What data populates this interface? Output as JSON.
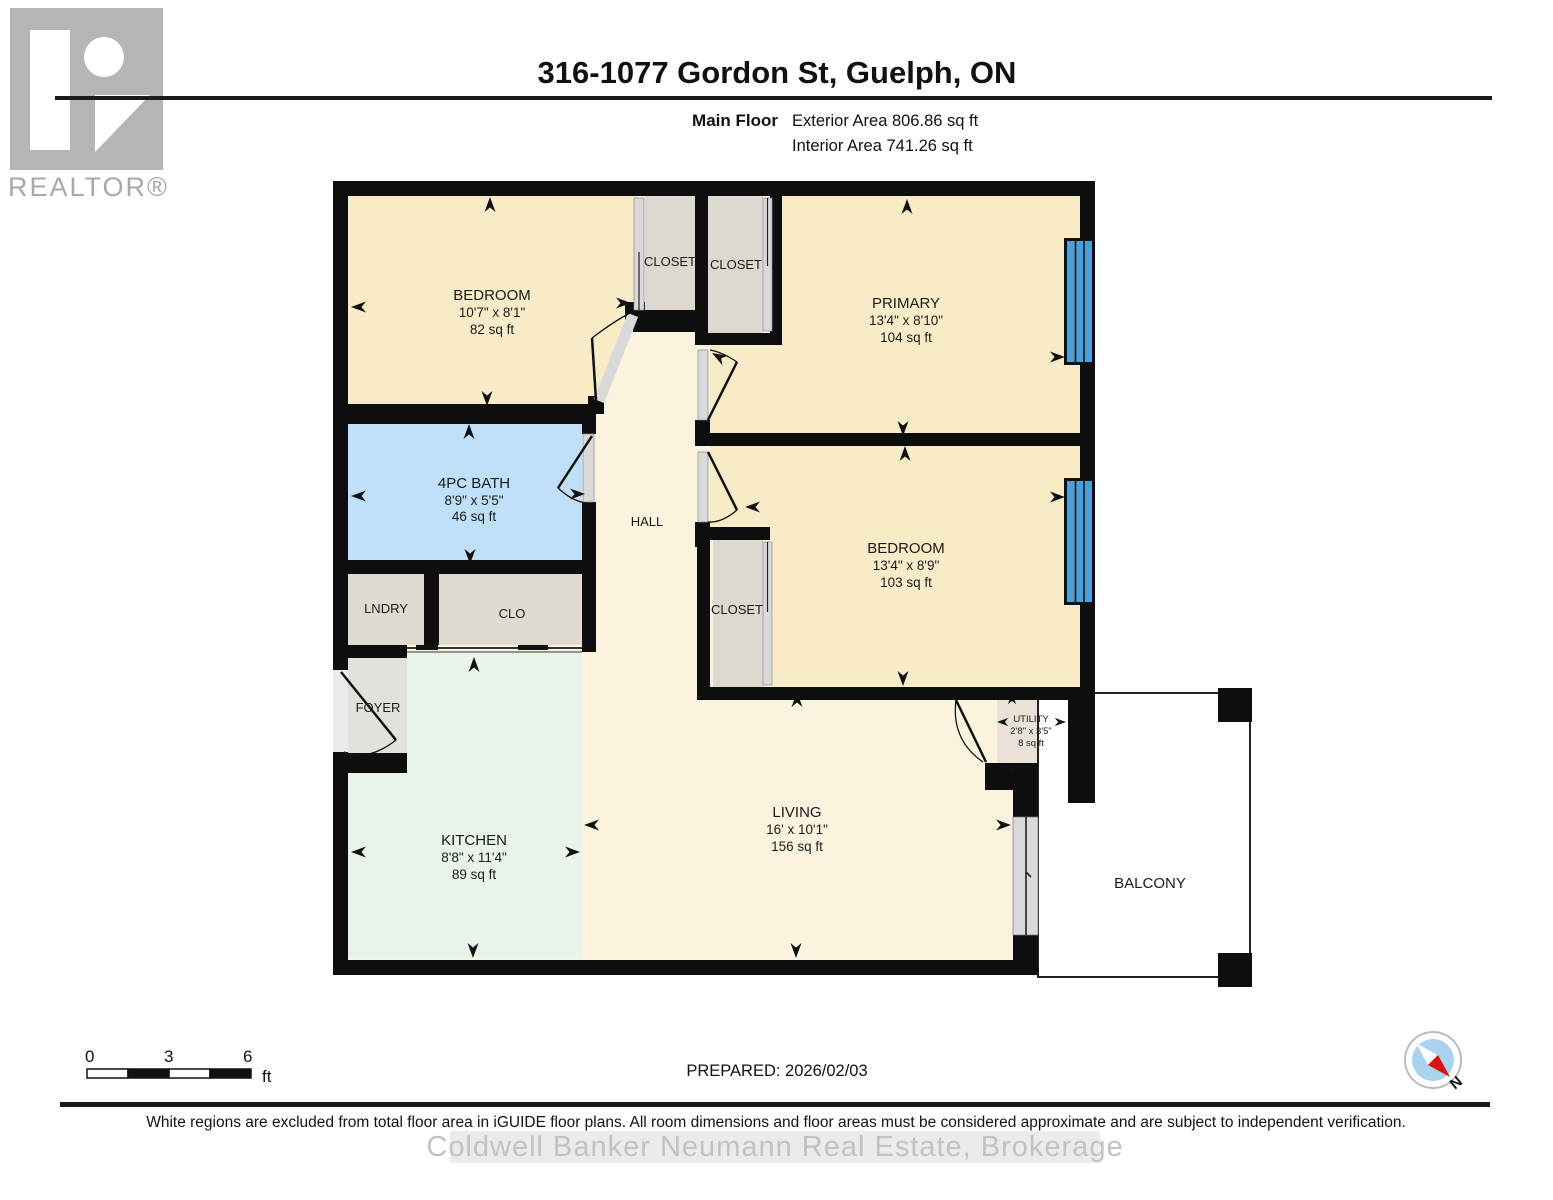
{
  "header": {
    "title": "316-1077 Gordon St, Guelph, ON",
    "floor_label": "Main Floor",
    "exterior_area": "Exterior Area 806.86 sq ft",
    "interior_area": "Interior Area 741.26 sq ft"
  },
  "branding": {
    "logo_letter": "R",
    "logo_wordmark": "REALTOR®"
  },
  "plan": {
    "bedroom1": {
      "name": "BEDROOM",
      "dims": "10'7\" x 8'1\"",
      "area": "82 sq ft"
    },
    "primary": {
      "name": "PRIMARY",
      "dims": "13'4\" x 8'10\"",
      "area": "104 sq ft"
    },
    "bedroom2": {
      "name": "BEDROOM",
      "dims": "13'4\" x 8'9\"",
      "area": "103 sq ft"
    },
    "bath": {
      "name": "4PC BATH",
      "dims": "8'9\" x 5'5\"",
      "area": "46 sq ft"
    },
    "kitchen": {
      "name": "KITCHEN",
      "dims": "8'8\" x 11'4\"",
      "area": "89 sq ft"
    },
    "living": {
      "name": "LIVING",
      "dims": "16' x 10'1\"",
      "area": "156 sq ft"
    },
    "utility": {
      "name": "UTILITY",
      "dims": "2'8\" x 3'5\"",
      "area": "8 sq ft"
    },
    "closet1": "CLOSET",
    "closet2": "CLOSET",
    "closet3": "CLOSET",
    "lndry": "LNDRY",
    "clo": "CLO",
    "hall": "HALL",
    "foyer": "FOYER",
    "balcony": "BALCONY"
  },
  "footer": {
    "scale_ticks": [
      "0",
      "3",
      "6"
    ],
    "scale_unit": "ft",
    "prepared": "PREPARED: 2026/02/03",
    "compass_label": "N",
    "disclaimer": "White regions are excluded from total floor area in iGUIDE floor plans. All room dimensions and floor areas must be considered approximate and are subject to independent verification.",
    "watermark": "Coldwell Banker Neumann Real Estate, Brokerage"
  },
  "colors": {
    "wall": "#0e0e0e",
    "window": "#4aa0d8",
    "room": "#f8ecc8",
    "hall_living": "#faf3dd",
    "bath": "#bfe0f8",
    "kitchen": "#e8f3ea",
    "closet": "#ded9cf",
    "door_jamb": "#d9d9d9",
    "compass_inner": "#a8d4f0",
    "compass_needle_red": "#dd1111",
    "watermark_gray": "#c2c2c2"
  },
  "icons": {
    "compass": "compass-icon",
    "dimension_arrow": "dimension-arrow-icon",
    "realtor_logo": "realtor-logo-icon"
  }
}
